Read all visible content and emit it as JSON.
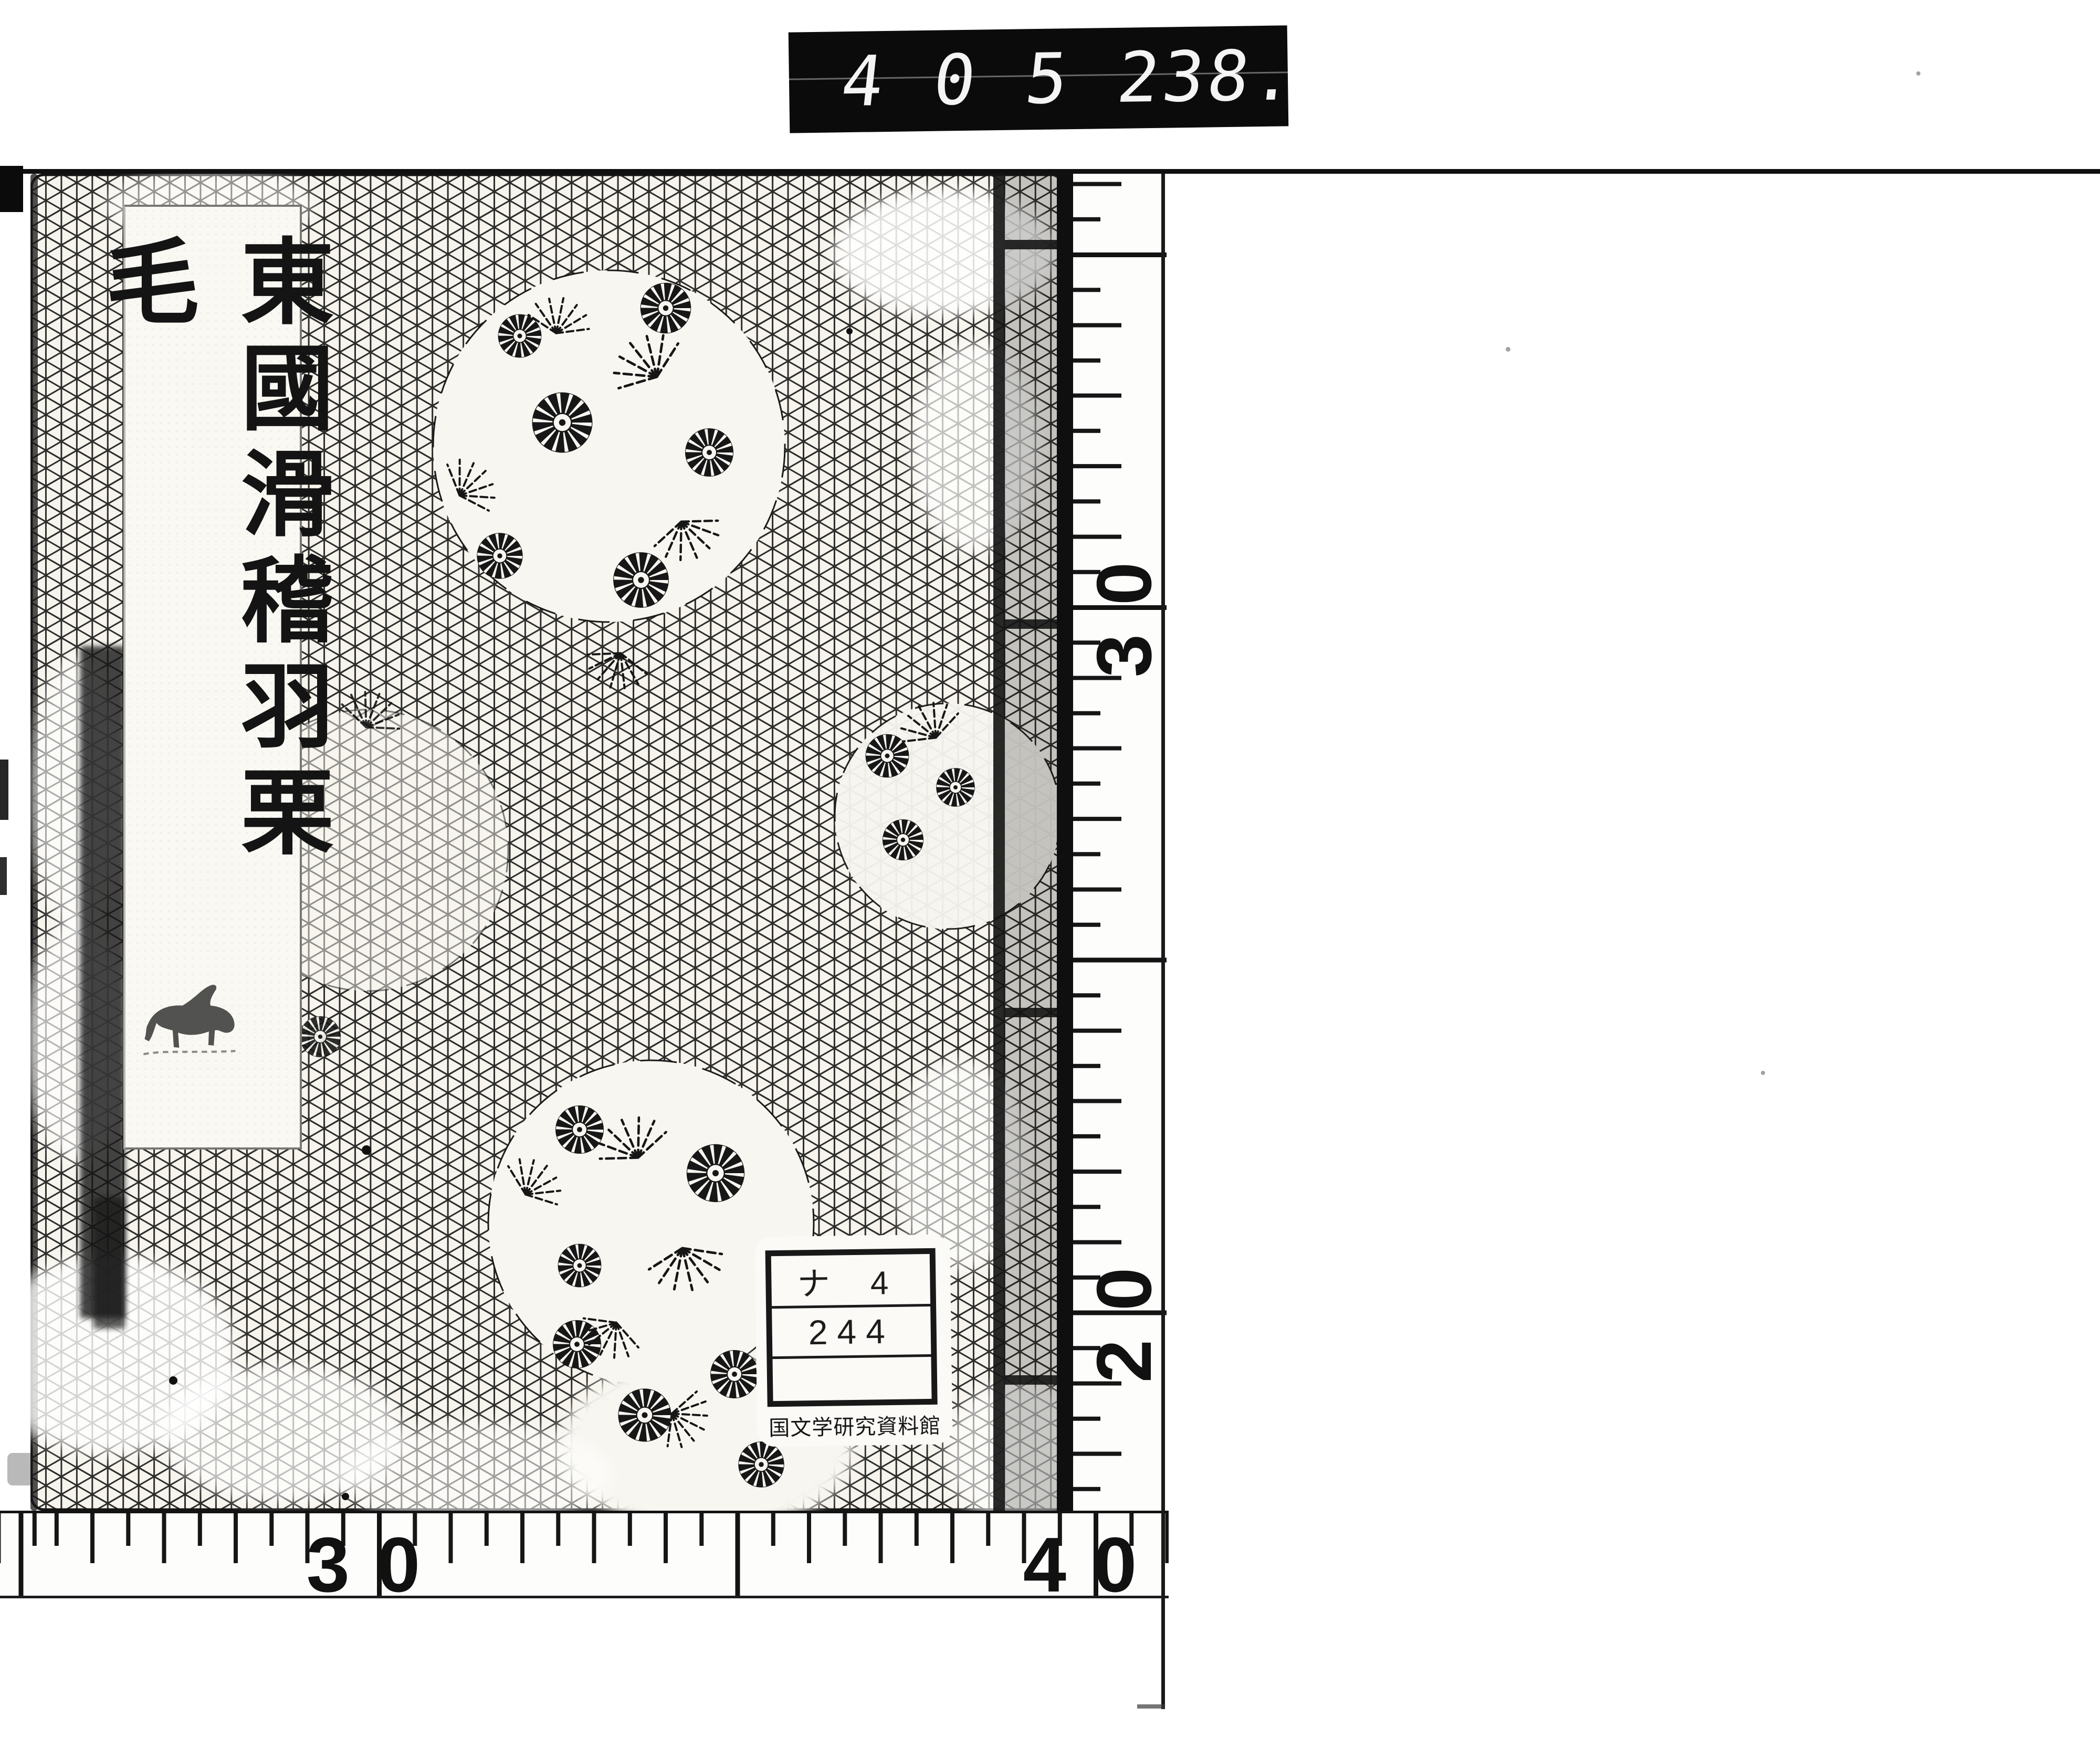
{
  "counter": {
    "left_value": "405",
    "right_value": "238."
  },
  "book": {
    "title": "東國滑稽羽栗毛"
  },
  "call_number_label": {
    "rows": [
      "ナ 4",
      "244",
      ""
    ],
    "institution": "国文学研究資料館"
  },
  "rulers": {
    "vertical": {
      "labels": [
        "30",
        "20"
      ]
    },
    "horizontal": {
      "labels": [
        "30",
        "40"
      ]
    }
  },
  "icons": {
    "cover_pattern": "asanoha-hemp-leaf-pattern",
    "medallions": "chrysanthemum-and-pine-roundels",
    "title_slip_mark": "horse-figure"
  }
}
